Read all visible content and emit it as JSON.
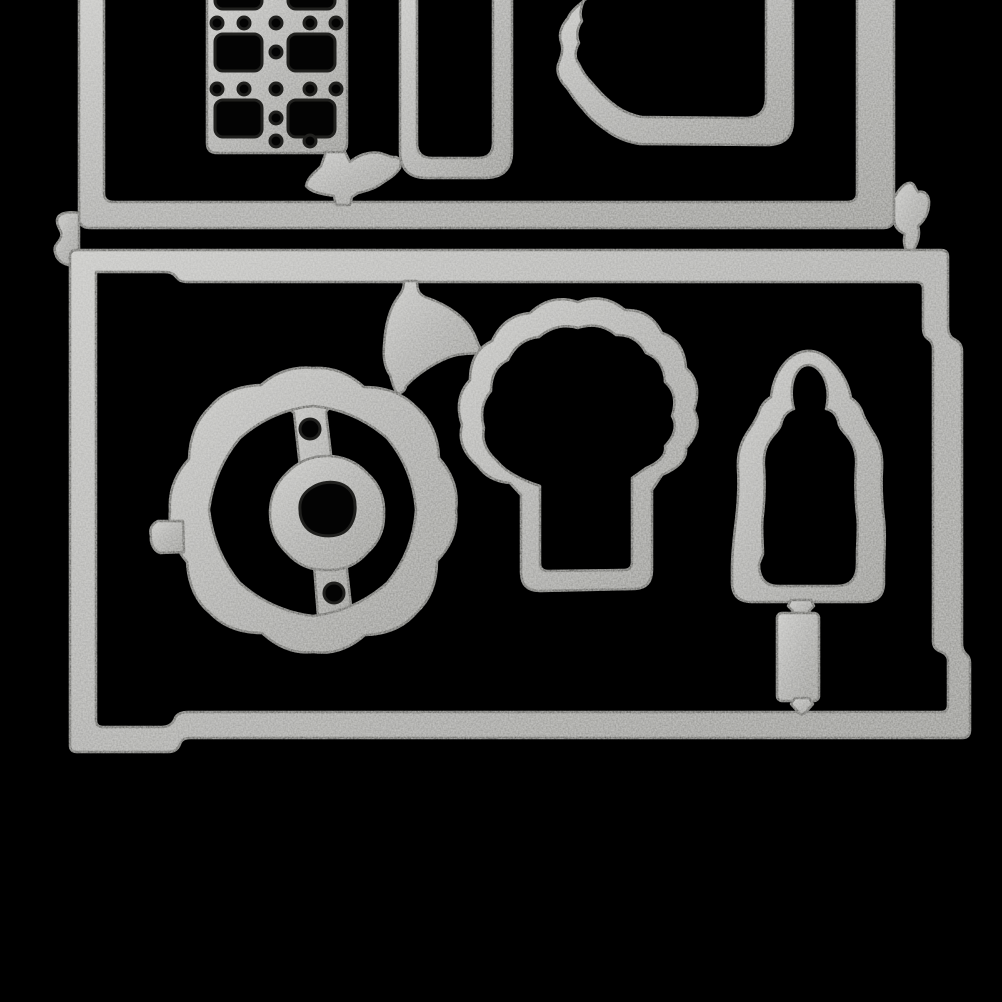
{
  "scene": {
    "type": "product-photo",
    "subject": "silver metal craft cutting die set on black background",
    "pieces": [
      "top-die-frame",
      "grid-window-die",
      "rounded-rect-die",
      "scalloped-edge-die",
      "connector-blob",
      "left-connector-tab",
      "right-connector-tab",
      "bottom-die-frame",
      "balloon-die",
      "wreath-die",
      "wreath-banner-strip",
      "wreath-center-ring",
      "broccoli-die",
      "baby-bottle-die",
      "bottle-base-piece"
    ]
  },
  "colors": {
    "background": "#000000",
    "metal_light": "#c3c3c1",
    "metal_mid": "#a2a2a0",
    "metal_dark": "#878783",
    "edge_shadow": "#45453f",
    "lip_line": "#20201e",
    "hole": "#030303",
    "speckle": "#d8d8d4"
  }
}
